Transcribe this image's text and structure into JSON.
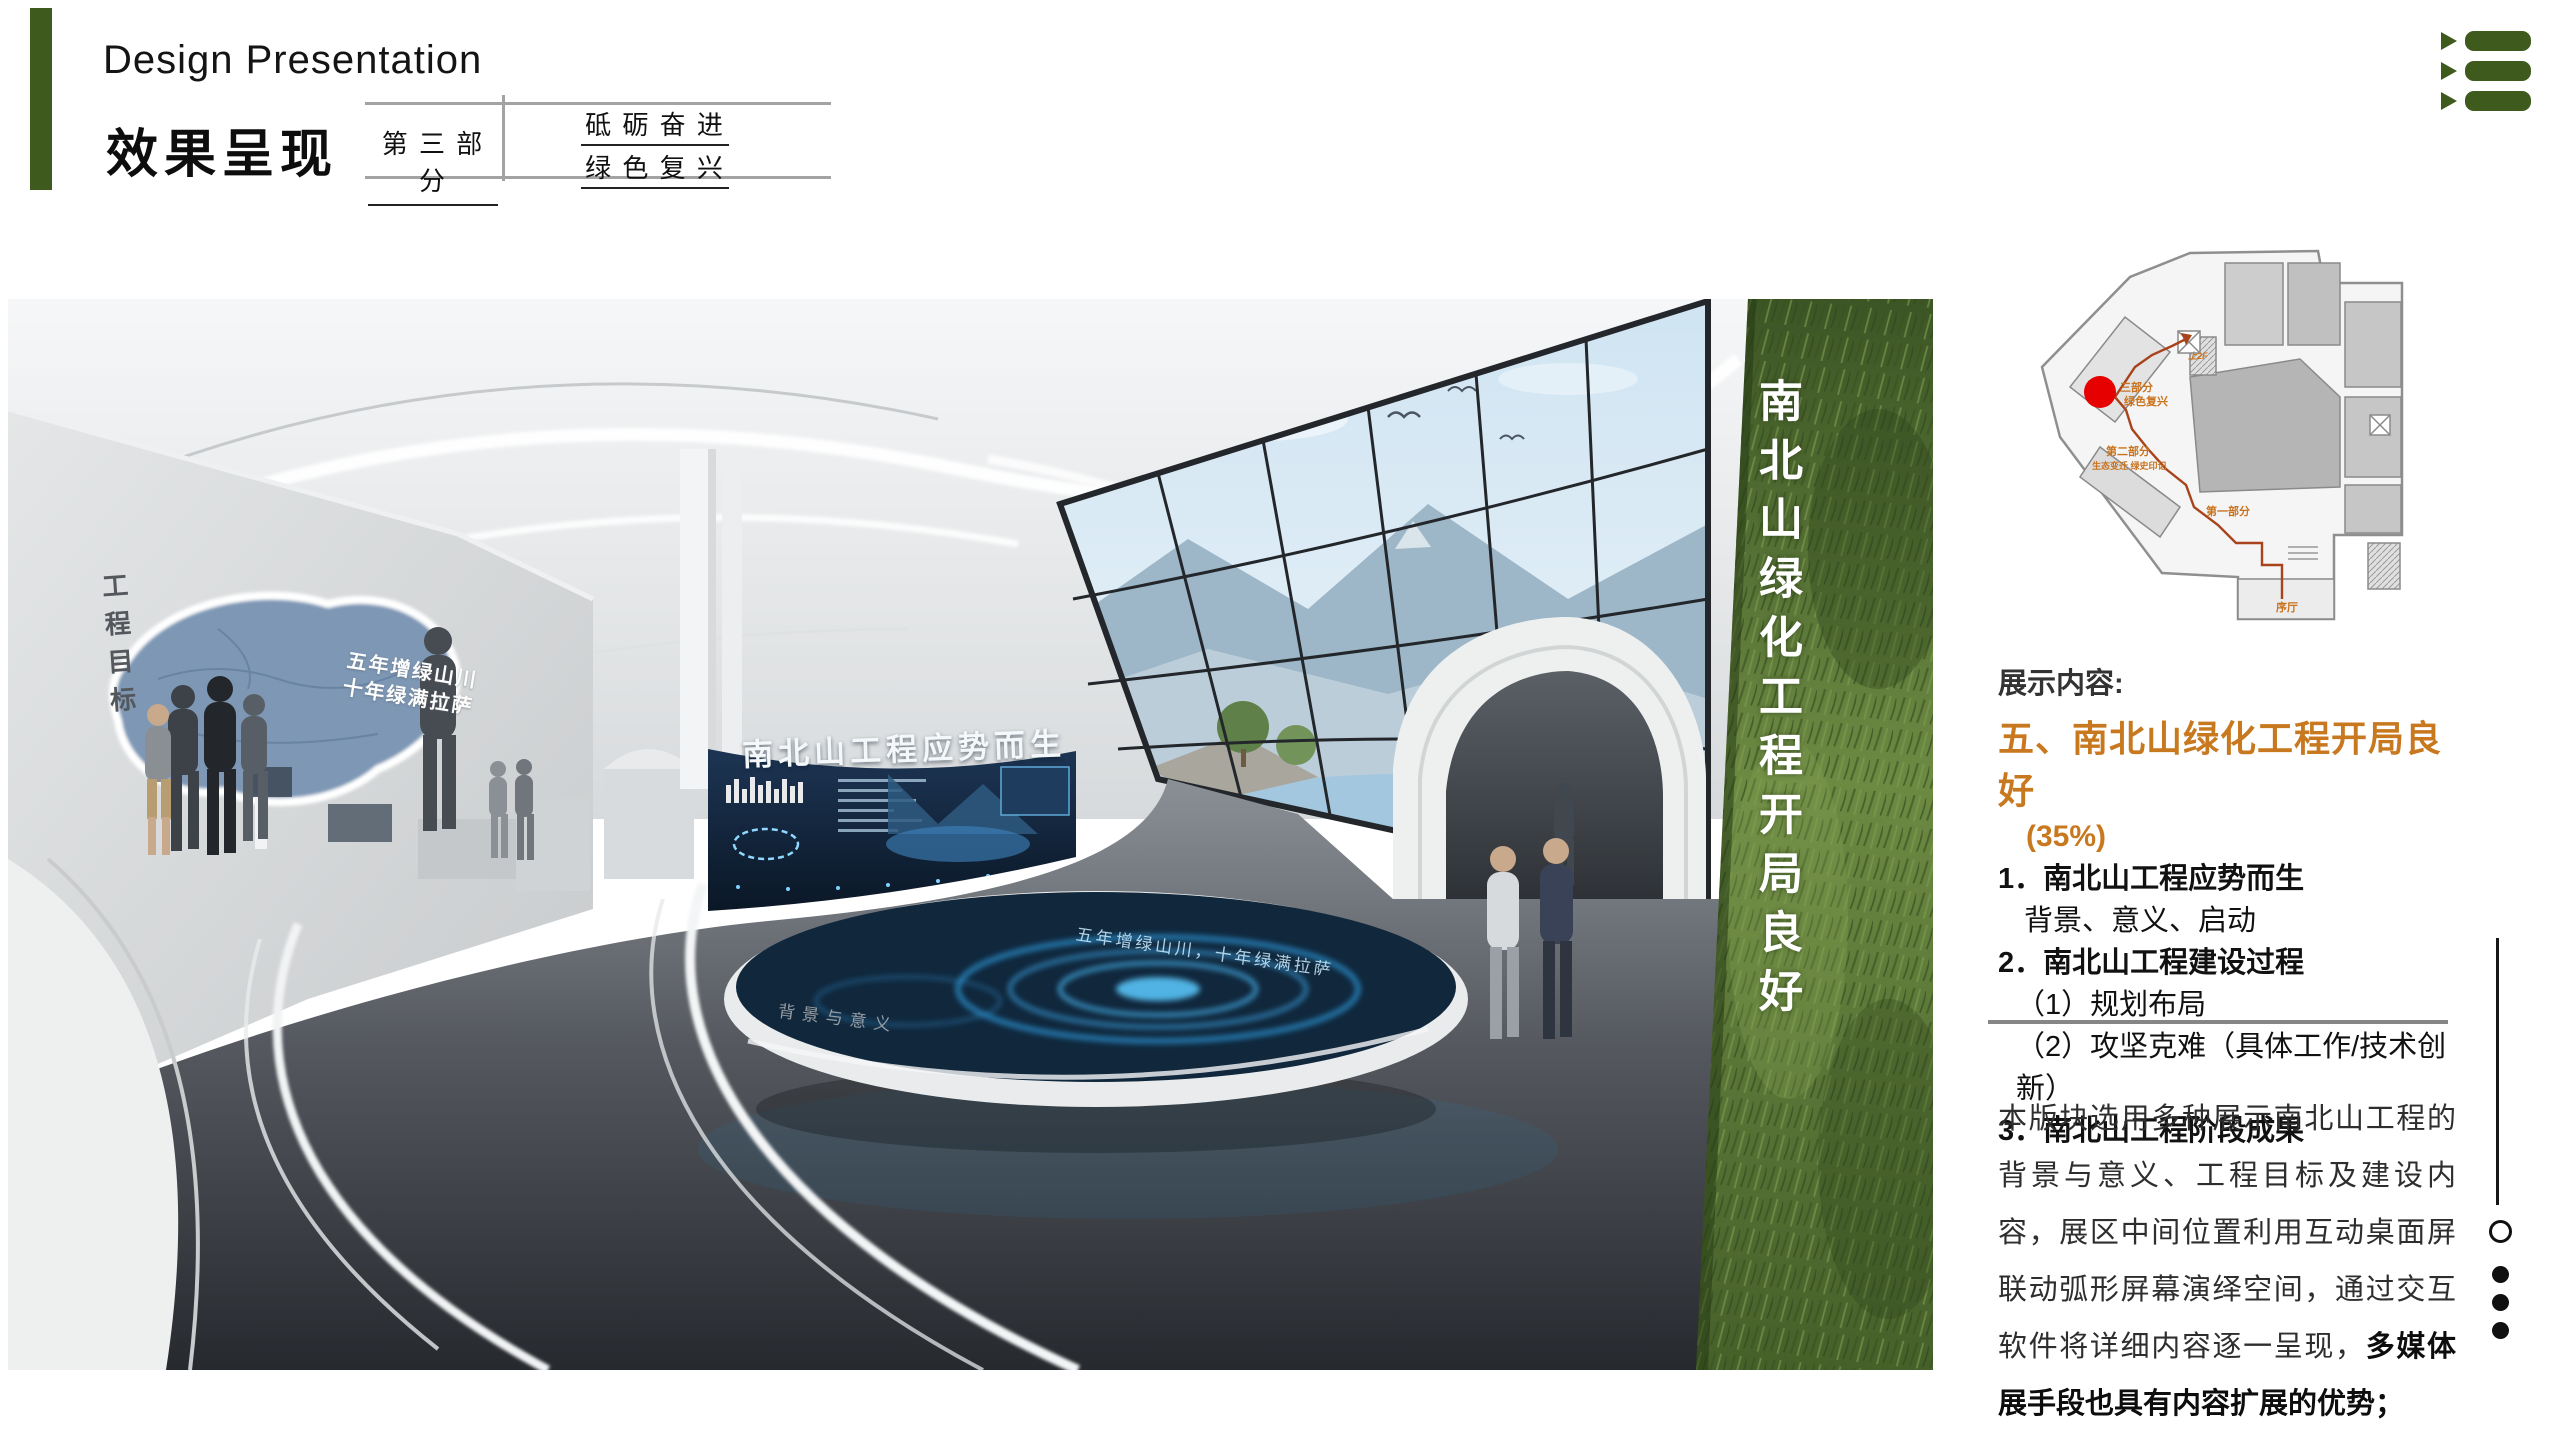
{
  "header": {
    "title_en": "Design Presentation",
    "title_cn": "效果呈现",
    "part_label": "第 三 部 分",
    "slogan_line1": "砥 砺 奋 进",
    "slogan_line2": "绿 色 复 兴"
  },
  "colors": {
    "accent_green": "#3f5a1d",
    "heading_orange": "#c8791f",
    "marker_red": "#e60000",
    "route_orange": "#a8431c"
  },
  "render": {
    "wall_vertical": "工程目标",
    "wall_slogan1": "五年增绿山川",
    "wall_slogan2": "十年绿满拉萨",
    "screen_title": "南北山工程应势而生",
    "table_slogan": "五年增绿山川，十年绿满拉萨",
    "table_front": "背景与意义",
    "green_wall_vertical": "南北山绿化工程开局良好"
  },
  "plan": {
    "part3_line1": "三部分",
    "part3_line2": "绿色复兴",
    "part2_line1": "第二部分",
    "part2_line2": "生态变迁 绿史印记",
    "part1": "第一部分",
    "lobby": "序厅",
    "up": "上2F"
  },
  "content": {
    "section_label": "展示内容:",
    "heading": "五、南北山绿化工程开局良好",
    "percent": "(35%)",
    "item1": "1．南北山工程应势而生",
    "item1_sub": "背景、意义、启动",
    "item2": "2．南北山工程建设过程",
    "item2_sub1": "（1）规划布局",
    "item2_sub2": "（2）攻坚克难（具体工作/技术创新）",
    "item3": "3．南北山工程阶段成果",
    "para_regular": "本版块选用多种展示南北山工程的背景与意义、工程目标及建设内容，展区中间位置利用互动桌面屏联动弧形屏幕演绎空间，通过交互软件将详细内容逐一呈现，",
    "para_bold": "多媒体展手段也具有内容扩展的优势；"
  }
}
